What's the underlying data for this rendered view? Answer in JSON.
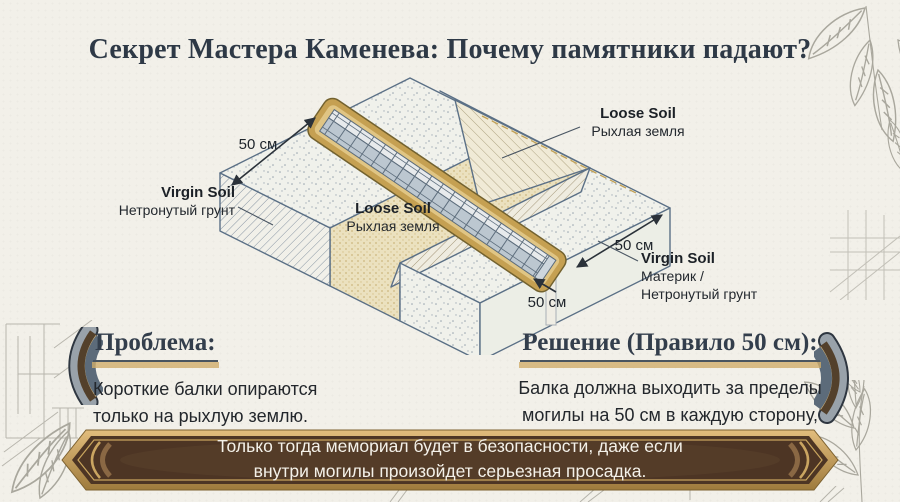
{
  "title": "Секрет Мастера Каменева: Почему памятники падают?",
  "diagram": {
    "dim_left": "50 см",
    "dim_right": "50 см",
    "dim_bottom": "50 см",
    "loose_soil_top": {
      "en": "Loose Soil",
      "ru": "Рыхлая земля"
    },
    "virgin_soil_left": {
      "en": "Virgin Soil",
      "ru": "Нетронутый грунт"
    },
    "loose_soil_pit": {
      "en": "Loose Soil",
      "ru": "Рыхлая земля"
    },
    "virgin_soil_right": {
      "en": "Virgin Soil",
      "ru_lines": [
        "Материк /",
        "Нетронутый грунт"
      ]
    }
  },
  "problem": {
    "heading": "Проблема:",
    "lines": [
      "Короткие балки опираются",
      "только на рыхлую землю."
    ]
  },
  "solution": {
    "heading": "Решение (Правило 50 см):",
    "lines": [
      "Балка должна выходить за пределы",
      "могилы на 50 см в каждую сторону,",
      "опираясь на твердый «материк»."
    ]
  },
  "banner": {
    "lines": [
      "Только тогда мемориал будет в безопасности, даже если",
      "внутри могилы произойдет серьезная просадка."
    ]
  },
  "colors": {
    "background": "#f2f0e9",
    "title_text": "#2e3946",
    "accent_gold": "#cfac6a",
    "banner_brown": "#4d3524",
    "banner_border_gold": "#c49a52",
    "beam_frame_gold": "#c5a052",
    "diagram_outline": "#5b7086",
    "loose_soil_tan": "#ebe1bf"
  }
}
